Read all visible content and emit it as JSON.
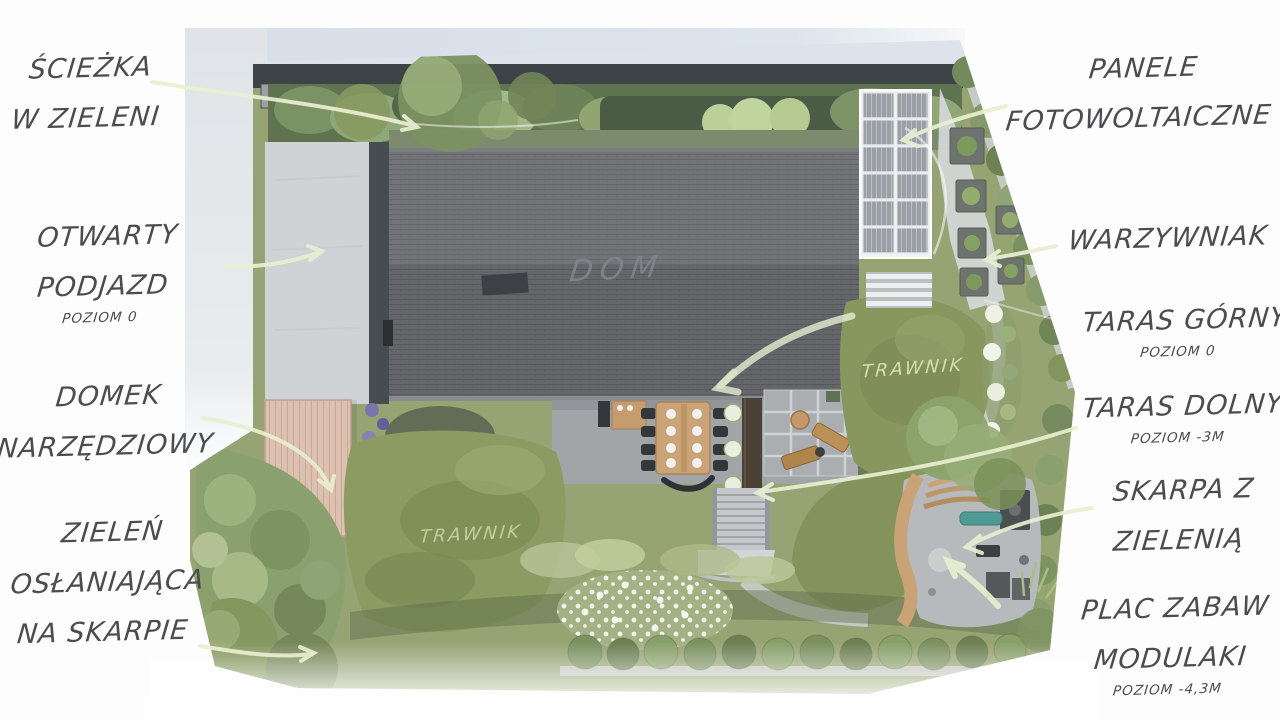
{
  "page_title": "Garden landscape design plan (top view)",
  "labels": {
    "left": [
      {
        "id": "sciezka",
        "lines": [
          "ŚCIEŻKA",
          "W ZIELENI"
        ]
      },
      {
        "id": "podjazd",
        "lines": [
          "OTWARTY",
          "PODJAZD"
        ],
        "sub": "POZIOM 0"
      },
      {
        "id": "domek",
        "lines": [
          "DOMEK",
          "NARZĘDZIOWY"
        ]
      },
      {
        "id": "zielen",
        "lines": [
          "ZIELEŃ",
          "OSŁANIAJĄCA",
          "NA SKARPIE"
        ]
      }
    ],
    "right": [
      {
        "id": "panele",
        "lines": [
          "PANELE",
          "FOTOWOLTAICZNE"
        ]
      },
      {
        "id": "warzywniak",
        "lines": [
          "WARZYWNIAK"
        ]
      },
      {
        "id": "taras-gorny",
        "lines": [
          "TARAS GÓRNY"
        ],
        "sub": "POZIOM 0"
      },
      {
        "id": "taras-dolny",
        "lines": [
          "TARAS DOLNY"
        ],
        "sub": "POZIOM -3M"
      },
      {
        "id": "skarpa",
        "lines": [
          "SKARPA Z",
          "ZIELENIĄ"
        ]
      },
      {
        "id": "plac-zabaw",
        "lines": [
          "PLAC ZABAW",
          "MODULAKI"
        ],
        "sub": "POZIOM -4,3M"
      }
    ]
  },
  "plan_annotations": {
    "house": "DOM",
    "lawn_right": "TRAWNIK",
    "lawn_left": "TRAWNIK"
  },
  "colors": {
    "label_text": "#4c4c4e",
    "roof": "#6a6c70",
    "driveway": "#cfd3d6",
    "street": "#dce3ea",
    "lawn": "#8a9a62",
    "hedge_dark": "#4a5c45",
    "shed_deck": "#dcc0b0",
    "terrace_paving": "#a2a5a8",
    "solar_cell": "#9aa0a6",
    "wood": "#c9a276",
    "playground_pad": "#b6babd",
    "arrow": "#e9efd1"
  }
}
